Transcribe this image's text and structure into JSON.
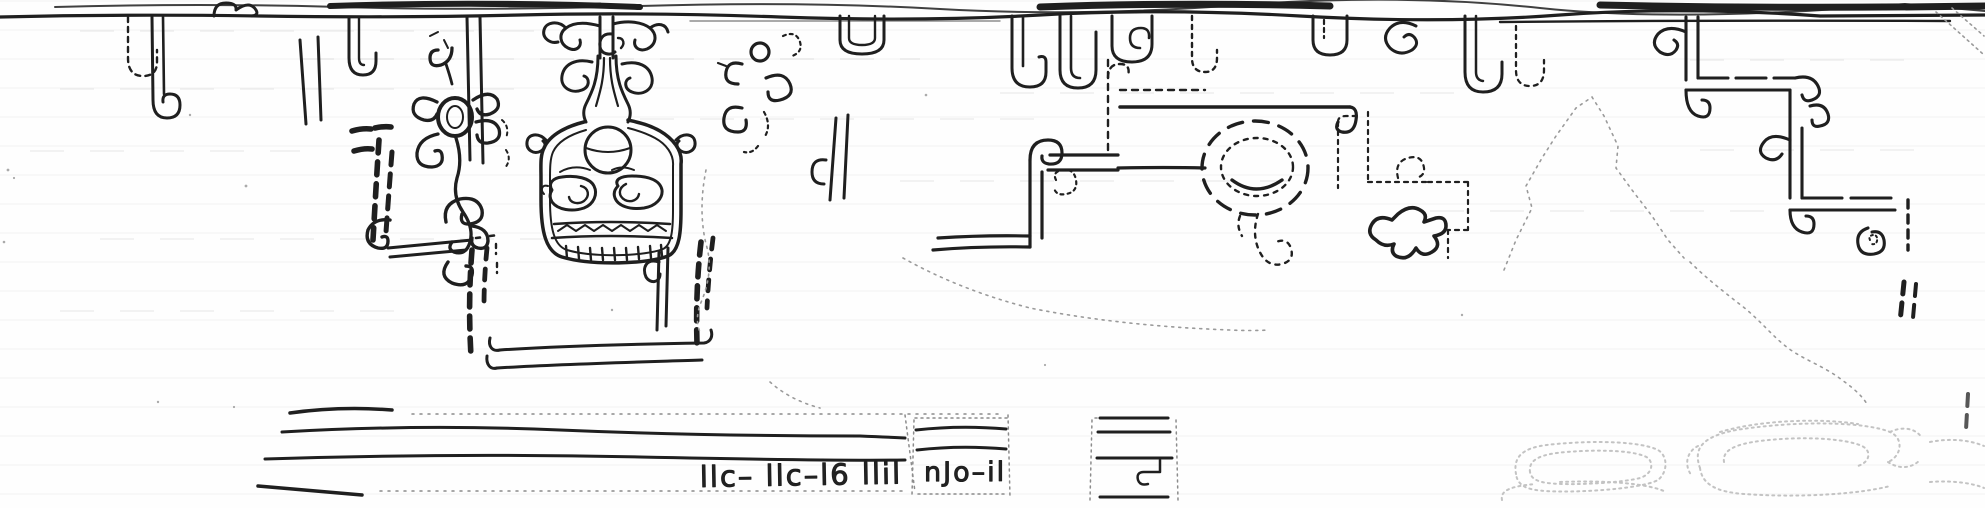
{
  "artwork": {
    "kind": "scanned pen-and-ink line drawing of a carved frieze band",
    "technique": "solid outlines with dashed restoration strokes and faint dotted ghost outlines",
    "orientation": "long horizontal band, torn dark edge along the top"
  },
  "colors": {
    "paper": "#fefefe",
    "ink": "#1f1f1f",
    "faint_ink": "#8c8c8c",
    "ghost_ink": "#c3c3c3"
  },
  "annotations": {
    "glyph_row": "llc– llc–l6  llil",
    "note": "nJo–il",
    "note_style": "upside-down pencil handwriting on the baseline"
  },
  "elements": [
    {
      "name": "top-torn-edge",
      "desc": "irregular heavy black line along the very top of the scan"
    },
    {
      "name": "border-rule",
      "desc": "long wavy horizontal rule just below the torn edge"
    },
    {
      "name": "border-hooks",
      "desc": "row of solid and dashed J and U hooks, small spirals and scroll pairs hanging from the rule"
    },
    {
      "name": "scroll-flower-motif",
      "desc": "rosette of curls around an oval ring with a long S-shaped tail"
    },
    {
      "name": "mask-face-motif",
      "desc": "frontal mask with forehead disc, two eye rings, zigzag mouth band, tooth row and a scroll headdress rising to the border"
    },
    {
      "name": "bold-dash-columns",
      "desc": "columns of heavy dashes beside and below the mask forming an open enclosure with a double base line"
    },
    {
      "name": "stepped-scroll-motif",
      "desc": "double-line step with curled hook, dashed upper continuation and a small dashed spiral"
    },
    {
      "name": "dashed-spiral-motif",
      "desc": "large dashed circle with inner dotted ring, solid smile arc and a curled dashed tail"
    },
    {
      "name": "dotted-step-meander",
      "desc": "dotted stepped line with a small dotted spiral"
    },
    {
      "name": "animal-scroll-motif",
      "desc": "small thick-outlined three-pronged scroll element"
    },
    {
      "name": "stepped-fret-right",
      "desc": "large descending step fret with spiral hooks at each corner ending in a volute and dashed edge"
    },
    {
      "name": "mountain-tear-line",
      "desc": "faint dotted peaked outline of a damaged / missing area"
    },
    {
      "name": "baseline-band",
      "desc": "three or four long horizontal base lines broken into separate blocks with dotted edges"
    },
    {
      "name": "handwritten-notes",
      "desc": "two groups of upside-down pencil scribbles sitting on the base lines"
    },
    {
      "name": "ghost-scroll-outlines",
      "desc": "very faint dotted volute bands in the lower right corner"
    }
  ]
}
